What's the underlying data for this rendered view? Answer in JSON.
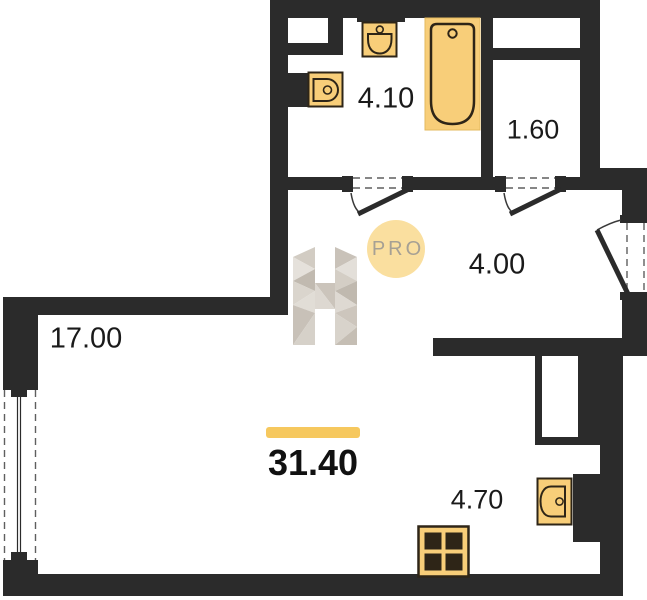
{
  "watermark": {
    "text": "PRO"
  },
  "total": {
    "area": "31.40"
  },
  "rooms": {
    "living": {
      "area": "17.00"
    },
    "bathroom": {
      "area": "4.10"
    },
    "wardrobe": {
      "area": "1.60"
    },
    "hallway": {
      "area": "4.00"
    },
    "kitchen": {
      "area": "4.70"
    }
  },
  "fixtures": [
    "bathtub",
    "washbasin",
    "toilet",
    "kitchen-sink",
    "stove"
  ],
  "colors": {
    "wall": "#2b2b2b",
    "fixture_fill": "#f8ce79",
    "fixture_outline": "#2e2517",
    "accent_bar": "#f6c85e",
    "badge_fill": "#fadf9f",
    "watermark_gray": "#d5cfc7"
  }
}
